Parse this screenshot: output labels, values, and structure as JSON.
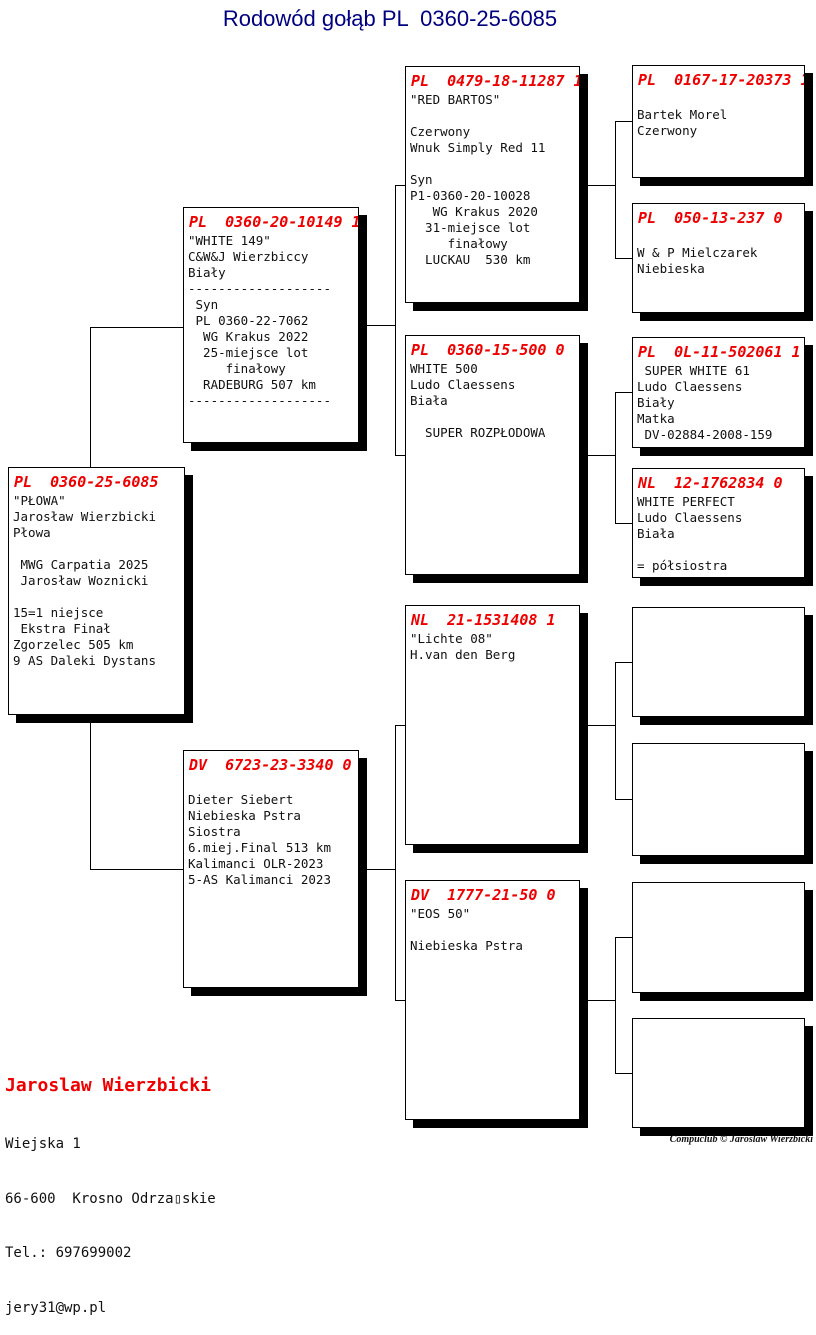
{
  "title": "Rodowód gołąb PL  0360-25-6085",
  "colors": {
    "ring_red": "#ee0000",
    "title_navy": "#000080"
  },
  "boxes": {
    "subject": {
      "header": "PL  0360-25-6085",
      "body": "\"PŁOWA\"\nJarosław Wierzbicki\nPłowa\n\n MWG Carpatia 2025\n Jarosław Woznicki\n\n15=1 niejsce\n Ekstra Finał\nZgorzelec 505 km\n9 AS Daleki Dystans"
    },
    "father": {
      "header": "PL  0360-20-10149 1",
      "body": "\"WHITE 149\"\nC&W&J Wierzbiccy\nBiały\n-------------------\n Syn\n PL 0360-22-7062\n  WG Krakus 2022\n  25-miejsce lot\n     finałowy\n  RADEBURG 507 km\n-------------------"
    },
    "mother": {
      "header": "DV  6723-23-3340 0",
      "body": "\nDieter Siebert\nNiebieska Pstra\nSiostra\n6.miej.Final 513 km\nKalimanci OLR-2023\n5-AS Kalimanci 2023"
    },
    "gp1": {
      "header": "PL  0479-18-11287 1",
      "body": "\"RED BARTOS\"\n\nCzerwony\nWnuk Simply Red 11\n\nSyn\nP1-0360-20-10028\n   WG Krakus 2020\n  31-miejsce lot\n     finałowy\n  LUCKAU  530 km"
    },
    "gp2": {
      "header": "PL  0360-15-500 0",
      "body": "WHITE 500\nLudo Claessens\nBiała\n\n  SUPER ROZPŁODOWA"
    },
    "gp3": {
      "header": "NL  21-1531408 1",
      "body": "\"Lichte 08\"\nH.van den Berg"
    },
    "gp4": {
      "header": "DV  1777-21-50 0",
      "body": "\"EOS 50\"\n\nNiebieska Pstra"
    },
    "ggp1": {
      "header": "PL  0167-17-20373 1",
      "body": "\nBartek Morel\nCzerwony"
    },
    "ggp2": {
      "header": "PL  050-13-237 0",
      "body": "\nW & P Mielczarek\nNiebieska"
    },
    "ggp3": {
      "header": "PL  0L-11-502061 1",
      "body": " SUPER WHITE 61\nLudo Claessens\nBiały\nMatka\n DV-02884-2008-159"
    },
    "ggp4": {
      "header": "NL  12-1762834 0",
      "body": "WHITE PERFECT\nLudo Claessens\nBiała\n\n= półsiostra"
    },
    "ggp5": {
      "header": "",
      "body": ""
    },
    "ggp6": {
      "header": "",
      "body": ""
    },
    "ggp7": {
      "header": "",
      "body": ""
    },
    "ggp8": {
      "header": "",
      "body": ""
    }
  },
  "footer": {
    "name": "Jaroslaw Wierzbicki",
    "address1": "Wiejska 1",
    "address2": "66-600  Krosno Odrza▯skie",
    "phone": "Tel.: 697699002",
    "email": "jery31@wp.pl"
  },
  "credit": "Compuclub © Jaroslaw Wierzbicki"
}
